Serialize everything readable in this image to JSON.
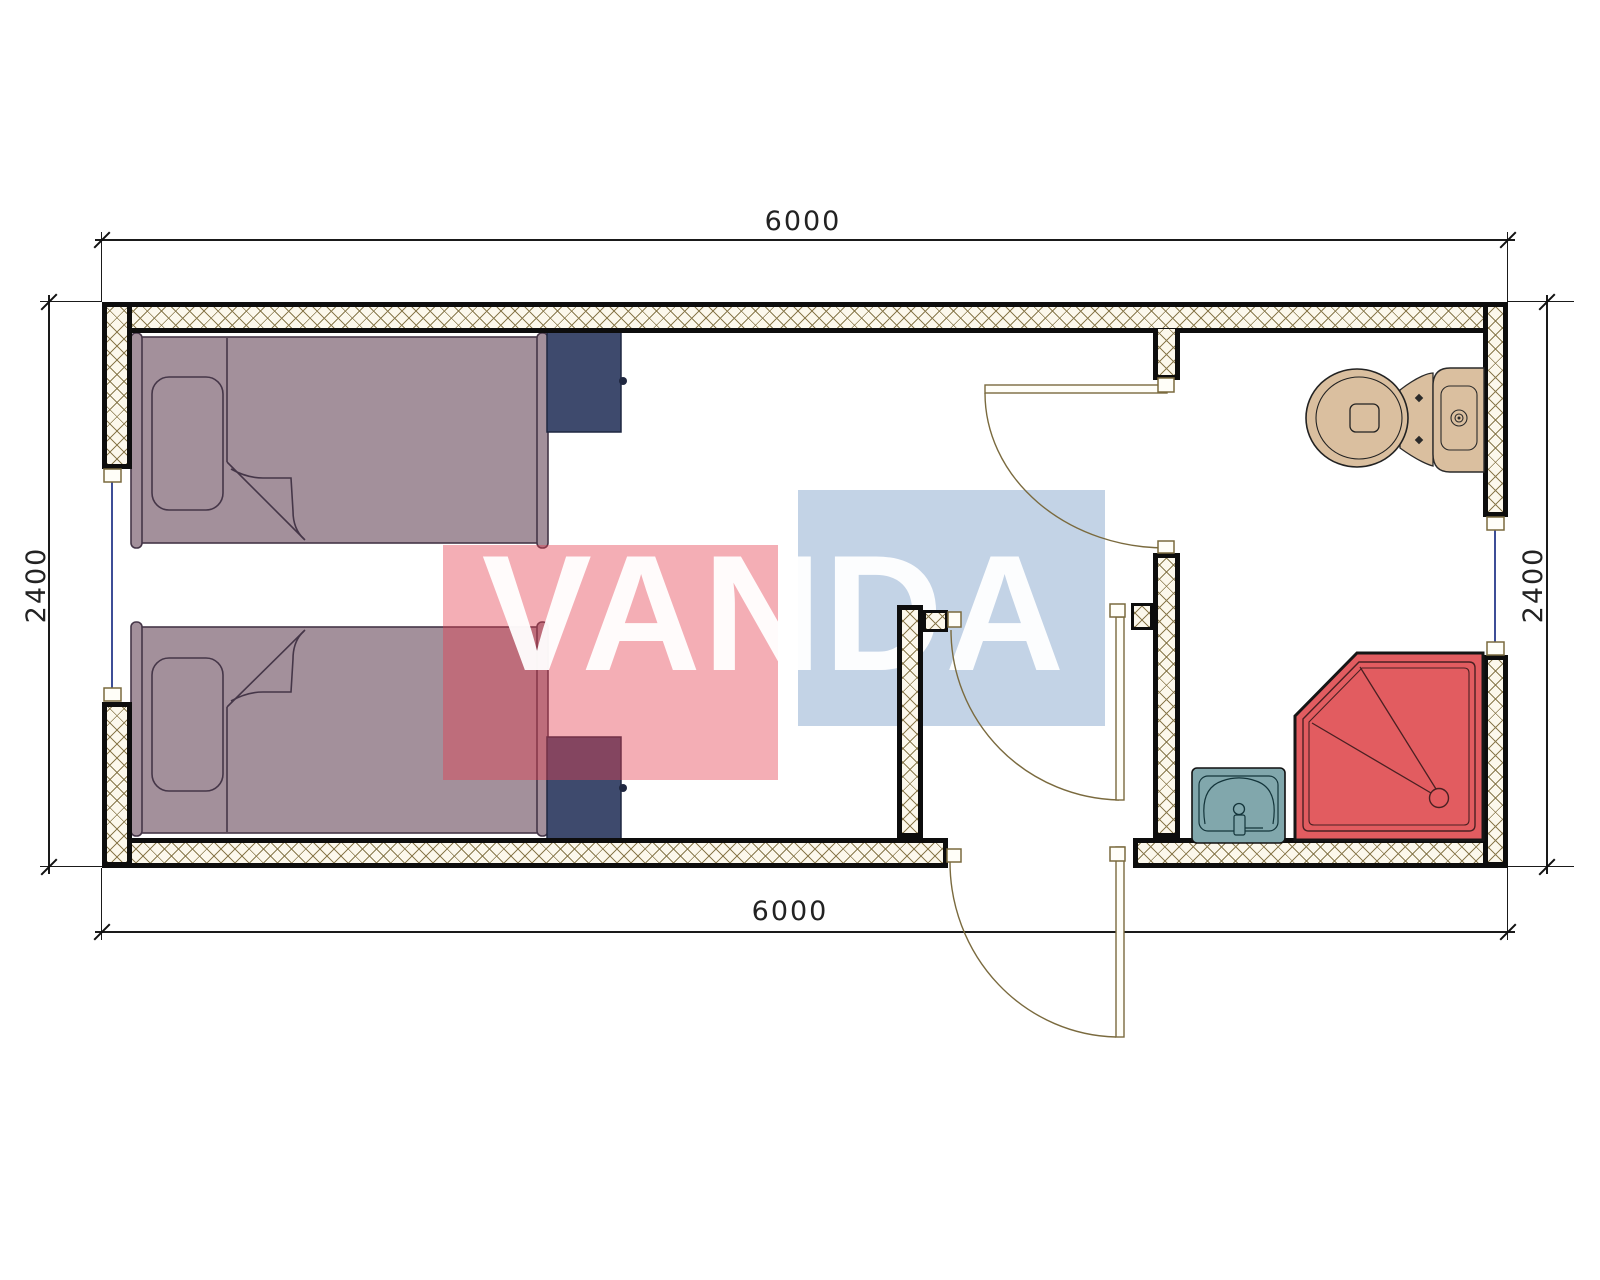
{
  "drawing": {
    "type": "architectural-floor-plan",
    "watermark": {
      "text": "VANDA",
      "red_block_color": "#e43e4e",
      "blue_block_color": "#82a2ca"
    },
    "dimensions": {
      "top": "6000",
      "bottom": "6000",
      "left": "2400",
      "right": "2400"
    },
    "palette": {
      "wall_hatch_line": "#8a7a4e",
      "wall_outline": "#0d0d0d",
      "bed_fill": "#a3909b",
      "cabinet_fill": "#3e4a6d",
      "toilet_fill": "#dabf9f",
      "sink_fill": "#81a7ac",
      "shower_fill": "#e25c60",
      "door_line": "#7a6a3e",
      "window_line": "#3d4e97"
    },
    "fixtures": {
      "beds": 2,
      "nightstands": 2,
      "toilet": 1,
      "shower_tray": 1,
      "sink": 1,
      "doors": 3,
      "windows": 3
    }
  }
}
